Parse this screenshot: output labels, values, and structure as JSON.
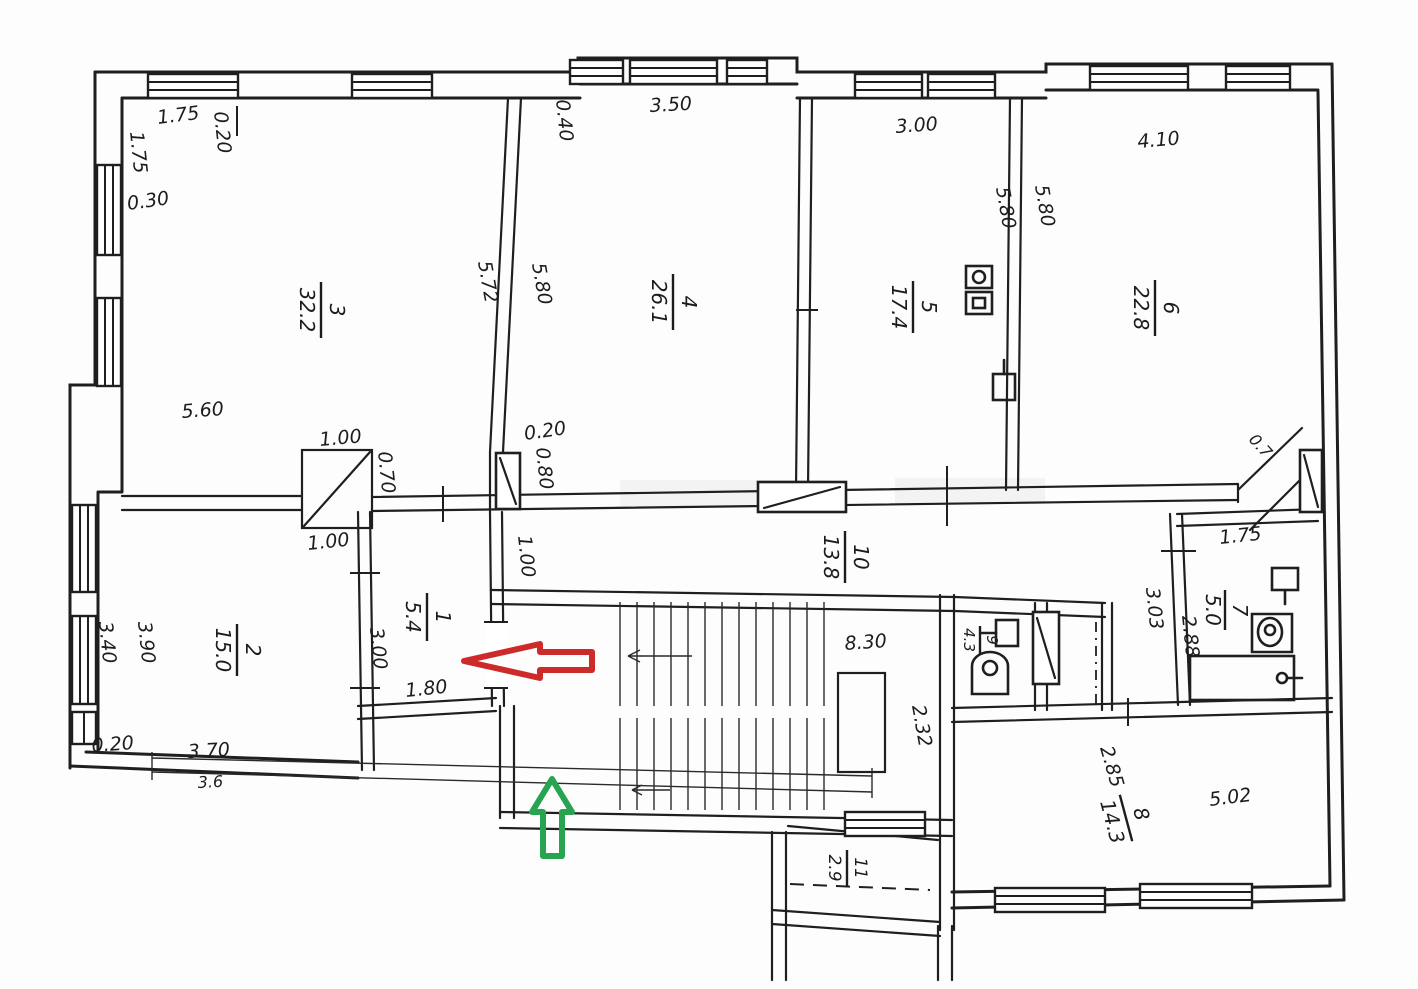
{
  "document": {
    "kind": "scanned apartment floor plan (BTI drawing)"
  },
  "colors": {
    "ink": "#1f1f1f",
    "red_arrow": "#cd2a2a",
    "green_arrow": "#28a34f",
    "paper": "#fdfdfd"
  },
  "rooms": [
    {
      "num": "1",
      "area": "5.4"
    },
    {
      "num": "2",
      "area": "15.0"
    },
    {
      "num": "3",
      "area": "32.2"
    },
    {
      "num": "4",
      "area": "26.1"
    },
    {
      "num": "5",
      "area": "17.4"
    },
    {
      "num": "6",
      "area": "22.8"
    },
    {
      "num": "7",
      "area": "5.0"
    },
    {
      "num": "8",
      "area": "14.3"
    },
    {
      "num": "9",
      "area": "4.3"
    },
    {
      "num": "10",
      "area": "13.8"
    },
    {
      "num": "11",
      "area": "2.9"
    }
  ],
  "dims": {
    "top_left_w": "1.75",
    "top_left_col": "0.20",
    "left_upper": "1.75",
    "left_step": "0.30",
    "room3_width": "5.60",
    "shaft_top": "1.00",
    "shaft_side": "0.70",
    "shaft_bottom": "1.00",
    "corridor_notch_w": "0.20",
    "corridor_notch_h": "0.80",
    "room1_door": "1.00",
    "room1_left": "3.00",
    "room1_bottom": "1.80",
    "room4_step": "0.40",
    "room4_top": "3.50",
    "wall34_a": "5.72",
    "wall34_b": "5.80",
    "room5_top": "3.00",
    "wall56_a": "5.80",
    "wall56_b": "5.80",
    "room6_top": "4.10",
    "room2_left_a": "3.40",
    "room2_left_b": "3.90",
    "room2_step": "0.20",
    "room2_bottom": "3.70",
    "room2_bottom_total": "3.6",
    "stairs_width": "8.30",
    "stairs_side": "2.32",
    "bath_top": "1.75",
    "bath_left": "3.03",
    "bath_inner": "2.88",
    "room8_left": "2.85",
    "room8_width": "5.02",
    "corner_cut": "0.7"
  }
}
